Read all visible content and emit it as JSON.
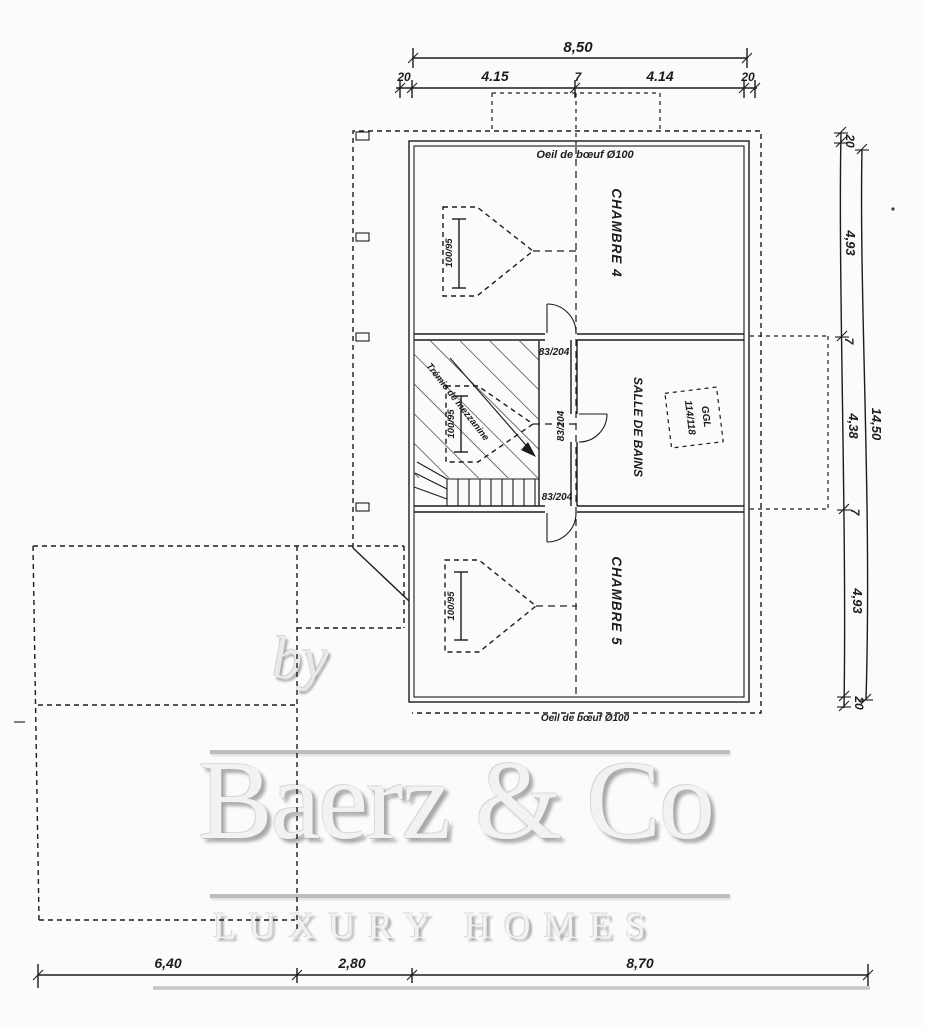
{
  "watermark": {
    "by": "by",
    "brand": "Baerz & Co",
    "tagline": "LUXURY HOMES"
  },
  "plan": {
    "oeil_top": "Oeil de bœuf Ø100",
    "oeil_bottom": "Oeil de bœuf Ø100",
    "room_top": "CHAMBRE 4",
    "room_middle": "SALLE DE BAINS",
    "room_bottom": "CHAMBRE 5",
    "roof_window_model": "GGL",
    "roof_window_size": "114/118",
    "stair_note": "Trémie de mezzanine",
    "door_top": "83/204",
    "door_middle": "83/204",
    "door_bottom": "83/204",
    "window_top": "100/95",
    "window_middle": "100/95",
    "window_bottom": "100/95"
  },
  "dimensions": {
    "top": {
      "total": "8,50",
      "seg": [
        "20",
        "4.15",
        "7",
        "4.14",
        "20"
      ]
    },
    "right": {
      "total": "14,50",
      "seg": [
        "20",
        "4,93",
        "7",
        "4,38",
        "7",
        "4,93",
        "20"
      ]
    },
    "bottom": {
      "seg": [
        "6,40",
        "2,80",
        "8,70"
      ]
    }
  },
  "colors": {
    "ink": "#1c1c1c",
    "watermark_gray": "#c9c9c9",
    "paper": "#fbfbf9"
  }
}
